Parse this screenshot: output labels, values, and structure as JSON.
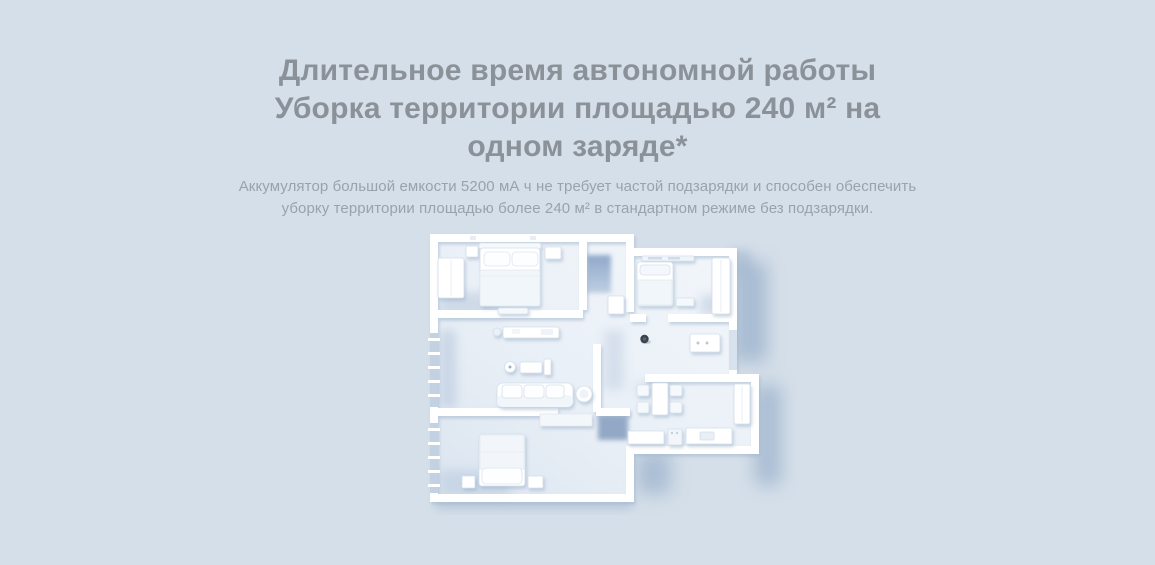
{
  "section": {
    "background_color": "#d5dfe9",
    "heading": {
      "color": "#8b9198",
      "lines": [
        "Длительное время автономной работы",
        "Уборка территории площадью 240 м² на",
        "одном заряде*"
      ]
    },
    "description": {
      "color": "#9aa2ab",
      "lines": [
        "Аккумулятор большой емкости 5200 мА ч не требует частой подзарядки и способен обеспечить",
        "уборку территории площадью более 240 м² в стандартном режиме без подзарядки."
      ]
    },
    "illustration": {
      "alt": "3D-план квартиры с мебелью и роботом-пылесосом, вид сверху",
      "colors": {
        "floor": "#edf2f8",
        "walls": "#ffffff",
        "cast_shadow": "#9db3cd",
        "robot": "#3c424b"
      }
    }
  }
}
